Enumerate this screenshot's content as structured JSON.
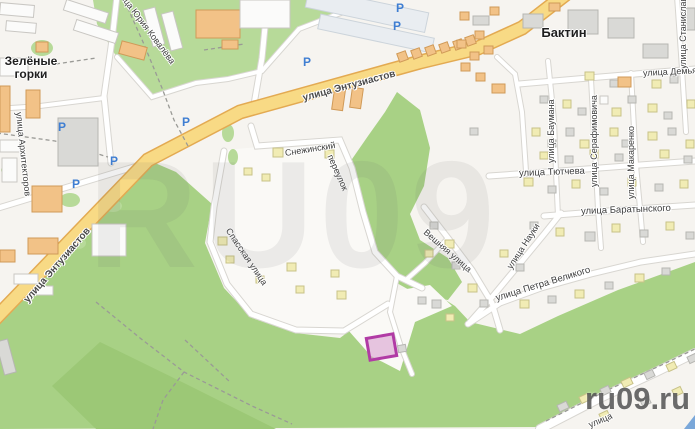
{
  "watermarks": {
    "big": "RU09",
    "corner": "ru09.ru"
  },
  "colors": {
    "base": "#f6f4f0",
    "pocket": "#faf9f6",
    "green_light": "#b7da99",
    "green_mid": "#a8d185",
    "green_dark": "#9cc876",
    "road_yellow": "#f8da85",
    "road_yellow_casing": "#e3aa52",
    "road_white": "#ffffff",
    "road_casing": "#d8d6d1",
    "dashed_path": "#9a9a96",
    "parking_blue": "#3f7ed2",
    "selection_border": "#b13ba5",
    "selection_fill": "rgba(216,160,208,0.6)",
    "corner_triangle": "#7aa7d9"
  },
  "place_labels": [
    {
      "text": "Зелёные горки",
      "x": 2,
      "y": 55,
      "size": 12,
      "width": 58
    },
    {
      "text": "Бактин",
      "x": 534,
      "y": 26,
      "size": 13,
      "width": 60
    }
  ],
  "street_labels": [
    {
      "text": "улица Энтузиастов",
      "x": 303,
      "y": 93,
      "rot": -15,
      "size": 10,
      "bold": true
    },
    {
      "text": "улица Энтузиастов",
      "x": 26,
      "y": 296,
      "rot": -49,
      "size": 10,
      "bold": true
    },
    {
      "text": "улица Юрия Ковалёва",
      "x": 117,
      "y": -17,
      "rot": 53,
      "size": 9
    },
    {
      "text": "улица Архитекторов",
      "x": 19,
      "y": 107,
      "rot": 84,
      "size": 9
    },
    {
      "text": "Снежинский",
      "x": 285,
      "y": 148,
      "rot": -9,
      "size": 9
    },
    {
      "text": "переулок",
      "x": 330,
      "y": 150,
      "rot": 66,
      "size": 9
    },
    {
      "text": "Спасская улица",
      "x": 228,
      "y": 224,
      "rot": 56,
      "size": 9
    },
    {
      "text": "Вешняя улица",
      "x": 425,
      "y": 226,
      "rot": 41,
      "size": 9
    },
    {
      "text": "улица Науки",
      "x": 509,
      "y": 263,
      "rot": -57,
      "size": 9
    },
    {
      "text": "улица Петра Великого",
      "x": 496,
      "y": 293,
      "rot": -17,
      "size": 9.5
    },
    {
      "text": "улица Тютчева",
      "x": 519,
      "y": 168,
      "rot": -2,
      "size": 9.5
    },
    {
      "text": "улица Баратынского",
      "x": 581,
      "y": 206,
      "rot": -2,
      "size": 9.5
    },
    {
      "text": "улица Баумана",
      "x": 551,
      "y": 158,
      "rot": -90,
      "size": 9
    },
    {
      "text": "улица Серафимовича",
      "x": 594,
      "y": 182,
      "rot": -90,
      "size": 9
    },
    {
      "text": "улица Макаренко",
      "x": 631,
      "y": 194,
      "rot": -90,
      "size": 9
    },
    {
      "text": "улица Станислав",
      "x": 683,
      "y": 64,
      "rot": -90,
      "size": 9
    },
    {
      "text": "улица Демьяна",
      "x": 643,
      "y": 68,
      "rot": -3,
      "size": 9
    },
    {
      "text": "улица",
      "x": 589,
      "y": 420,
      "rot": -23,
      "size": 9
    }
  ],
  "parking_icons": {
    "glyph": "P",
    "positions": [
      [
        58,
        121
      ],
      [
        72,
        178
      ],
      [
        110,
        155
      ],
      [
        182,
        116
      ],
      [
        303,
        56
      ],
      [
        393,
        20
      ],
      [
        396,
        2
      ]
    ]
  },
  "selection": {
    "x": 368,
    "y": 336,
    "w": 27,
    "h": 22,
    "rot": -10
  },
  "geometry": {
    "green_light_polys": [
      "93,0 345,0 336,16 298,30 260,72 228,80 194,82 152,98 116,56 97,24"
    ],
    "green_mid_polys": [
      "0,318 148,160 176,172 212,204 205,243 224,288 252,318 295,333 340,338 380,308 430,290 455,306 470,322 520,334 558,316 618,290 695,262 695,352 656,371 598,399 545,427 0,429",
      "397,92 420,110 430,148 424,186 410,214 420,240 448,258 462,282 448,300 420,296 395,282 372,252 362,222 346,196 350,162 368,136 385,112"
    ],
    "green_dark_polys": [
      "100,342 186,384 258,420 276,429 96,429 52,386"
    ],
    "pocket_polys": [
      "224,150 342,140 352,168 374,252 397,278 391,302 343,332 295,328 249,312 226,283 209,243 215,206",
      "336,301 430,285 452,306 415,322 400,371 371,356 348,330"
    ],
    "green_ovals": [
      [
        42,
        48,
        11,
        8
      ],
      [
        70,
        200,
        10,
        7
      ],
      [
        113,
        206,
        9,
        6
      ],
      [
        78,
        243,
        8,
        6
      ],
      [
        228,
        133,
        6,
        9
      ],
      [
        233,
        157,
        5,
        8
      ],
      [
        8,
        170,
        7,
        5
      ]
    ],
    "roads_yellow": [
      "M -8,322 L 148,160 L 240,112 L 420,62 L 478,48 L 522,28 L 566,-6"
    ],
    "roads_white": [
      [
        "M 268,-4 L 262,58 L 253,110",
        5
      ],
      [
        "M 251,126 L 257,146 L 340,140 L 352,168 L 363,212 L 375,252 L 397,276 L 422,288",
        5
      ],
      [
        "M 224,151 L 214,207 L 210,242 L 227,284 L 251,314 L 296,330 L 344,331 L 388,304",
        5
      ],
      [
        "M 397,276 L 390,312 L 401,347 L 412,374",
        4
      ],
      [
        "M 424,207 L 448,238 L 472,270 L 492,303 L 500,330",
        5
      ],
      [
        "M 448,238 L 425,263 L 407,279",
        4
      ],
      [
        "M 470,322 L 493,296 L 517,267 L 545,233 L 561,213",
        5
      ],
      [
        "M 468,324 L 500,303 L 541,288 L 591,274 L 641,262 L 695,254",
        5
      ],
      [
        "M 489,176 L 560,171 L 640,165 L 695,161",
        5
      ],
      [
        "M 544,216 L 620,210 L 695,205",
        5
      ],
      [
        "M 519,84 L 600,77 L 695,69",
        5
      ],
      [
        "M 548,61 L 554,120 L 556,172 L 558,216",
        4
      ],
      [
        "M 591,79 L 596,170 L 598,209 L 601,248",
        4
      ],
      [
        "M 631,73 L 636,165 L 640,208 L 643,242",
        4
      ],
      [
        "M 677,-4 L 682,69 L 686,132",
        4
      ],
      [
        "M 497,57 L 515,74 L 522,112 L 526,171",
        4
      ],
      [
        "M 540,429 L 600,398 L 656,372 L 695,353",
        8
      ],
      [
        "M -5,209 L 147,163",
        5
      ],
      [
        "M 111,163 L 104,96 L 112,40 L 117,-4",
        5
      ],
      [
        "M 104,98 L 40,106 L -4,109",
        4
      ],
      [
        "M 117,57 L 152,97 L 196,83 L 228,79 L 262,71 L 299,29 L 338,14 L 362,6",
        4
      ]
    ],
    "dashed_paths": [
      "M 122,-5 L 143,42 L 162,88 L 174,120 L 188,146",
      "M -3,133 L 55,141 L 108,157",
      "M 96,302 L 140,338 L 184,372 L 216,388 L 252,406 L 292,424",
      "M 184,372 L 163,400 L 153,429",
      "M 185,340 L 230,382",
      "M 546,421 L 610,389 L 670,361 L 695,349",
      "M 56,64 L 96,58",
      "M 204,50 L 244,44"
    ],
    "buildings": [
      [
        64,
        6,
        44,
        11,
        "w",
        18
      ],
      [
        74,
        26,
        44,
        11,
        "w",
        18
      ],
      [
        148,
        8,
        12,
        38,
        "w",
        -15
      ],
      [
        166,
        12,
        12,
        38,
        "w",
        -15
      ],
      [
        196,
        10,
        44,
        28,
        "o",
        0
      ],
      [
        222,
        40,
        16,
        9,
        "o",
        0
      ],
      [
        240,
        0,
        50,
        28,
        "w",
        0
      ],
      [
        306,
        0,
        122,
        20,
        "lg",
        12
      ],
      [
        318,
        26,
        116,
        15,
        "lg",
        12
      ],
      [
        398,
        52,
        9,
        9,
        "o",
        -20
      ],
      [
        412,
        49,
        9,
        9,
        "o",
        -20
      ],
      [
        426,
        46,
        9,
        9,
        "o",
        -20
      ],
      [
        440,
        43,
        9,
        9,
        "o",
        -20
      ],
      [
        454,
        40,
        9,
        9,
        "o",
        -20
      ],
      [
        466,
        36,
        9,
        9,
        "o",
        -20
      ],
      [
        333,
        90,
        11,
        20,
        "o",
        8
      ],
      [
        351,
        88,
        11,
        20,
        "o",
        8
      ],
      [
        120,
        44,
        26,
        13,
        "o",
        15
      ],
      [
        36,
        42,
        12,
        10,
        "o",
        0
      ],
      [
        0,
        4,
        34,
        12,
        "w",
        5
      ],
      [
        6,
        22,
        30,
        10,
        "w",
        5
      ],
      [
        0,
        58,
        28,
        18,
        "w",
        0
      ],
      [
        0,
        86,
        10,
        46,
        "o",
        0
      ],
      [
        26,
        90,
        14,
        28,
        "o",
        0
      ],
      [
        58,
        118,
        40,
        48,
        "g",
        0
      ],
      [
        0,
        140,
        20,
        12,
        "w",
        0
      ],
      [
        2,
        158,
        15,
        24,
        "w",
        0
      ],
      [
        32,
        186,
        30,
        26,
        "o",
        0
      ],
      [
        28,
        238,
        30,
        16,
        "o",
        0
      ],
      [
        92,
        224,
        34,
        32,
        "w",
        0
      ],
      [
        0,
        250,
        15,
        12,
        "o",
        0
      ],
      [
        14,
        274,
        24,
        10,
        "w",
        0
      ],
      [
        36,
        286,
        17,
        9,
        "w",
        0
      ],
      [
        0,
        340,
        12,
        34,
        "g",
        -15
      ],
      [
        460,
        12,
        9,
        8,
        "o",
        0
      ],
      [
        473,
        16,
        16,
        9,
        "g",
        0
      ],
      [
        475,
        31,
        9,
        8,
        "o",
        0
      ],
      [
        490,
        7,
        9,
        8,
        "o",
        0
      ],
      [
        523,
        14,
        20,
        14,
        "g",
        0
      ],
      [
        549,
        3,
        11,
        8,
        "o",
        0
      ],
      [
        568,
        10,
        30,
        24,
        "g",
        0
      ],
      [
        608,
        18,
        26,
        20,
        "g",
        0
      ],
      [
        643,
        44,
        25,
        14,
        "g",
        0
      ],
      [
        683,
        8,
        12,
        22,
        "g",
        0
      ],
      [
        457,
        40,
        9,
        8,
        "o",
        0
      ],
      [
        470,
        52,
        9,
        8,
        "o",
        0
      ],
      [
        484,
        46,
        9,
        8,
        "o",
        0
      ],
      [
        461,
        63,
        9,
        8,
        "o",
        0
      ],
      [
        476,
        73,
        9,
        8,
        "o",
        0
      ],
      [
        492,
        84,
        13,
        9,
        "o",
        0
      ],
      [
        585,
        72,
        9,
        8,
        "py",
        0
      ],
      [
        610,
        80,
        8,
        7,
        "g",
        0
      ],
      [
        618,
        77,
        13,
        10,
        "o",
        0
      ],
      [
        652,
        80,
        9,
        8,
        "py",
        0
      ],
      [
        670,
        76,
        8,
        7,
        "g",
        0
      ],
      [
        540,
        96,
        8,
        7,
        "g",
        0
      ],
      [
        563,
        100,
        8,
        8,
        "py",
        0
      ],
      [
        578,
        108,
        8,
        7,
        "g",
        0
      ],
      [
        600,
        96,
        8,
        8,
        "w",
        0
      ],
      [
        612,
        108,
        9,
        8,
        "py",
        0
      ],
      [
        628,
        96,
        8,
        7,
        "g",
        0
      ],
      [
        648,
        104,
        9,
        8,
        "py",
        0
      ],
      [
        664,
        112,
        8,
        7,
        "g",
        0
      ],
      [
        687,
        100,
        8,
        8,
        "py",
        0
      ],
      [
        470,
        128,
        8,
        7,
        "g",
        0
      ],
      [
        532,
        128,
        8,
        8,
        "py",
        0
      ],
      [
        548,
        140,
        8,
        7,
        "g",
        0
      ],
      [
        566,
        128,
        8,
        8,
        "g",
        0
      ],
      [
        580,
        140,
        9,
        8,
        "py",
        0
      ],
      [
        610,
        128,
        8,
        8,
        "py",
        0
      ],
      [
        622,
        140,
        8,
        7,
        "g",
        0
      ],
      [
        648,
        132,
        9,
        8,
        "py",
        0
      ],
      [
        668,
        128,
        8,
        7,
        "g",
        0
      ],
      [
        686,
        140,
        8,
        8,
        "py",
        0
      ],
      [
        540,
        152,
        8,
        7,
        "py",
        0
      ],
      [
        565,
        156,
        8,
        7,
        "g",
        0
      ],
      [
        590,
        150,
        8,
        8,
        "py",
        0
      ],
      [
        615,
        154,
        8,
        7,
        "g",
        0
      ],
      [
        660,
        150,
        9,
        8,
        "py",
        0
      ],
      [
        684,
        156,
        8,
        7,
        "g",
        0
      ],
      [
        524,
        178,
        9,
        8,
        "py",
        0
      ],
      [
        548,
        186,
        8,
        7,
        "g",
        0
      ],
      [
        572,
        180,
        8,
        8,
        "py",
        0
      ],
      [
        600,
        188,
        8,
        7,
        "g",
        0
      ],
      [
        628,
        178,
        8,
        8,
        "py",
        0
      ],
      [
        655,
        184,
        8,
        7,
        "g",
        0
      ],
      [
        680,
        180,
        8,
        8,
        "py",
        0
      ],
      [
        530,
        222,
        8,
        7,
        "g",
        0
      ],
      [
        556,
        228,
        8,
        8,
        "py",
        0
      ],
      [
        585,
        232,
        10,
        9,
        "g",
        0
      ],
      [
        612,
        224,
        8,
        8,
        "py",
        0
      ],
      [
        640,
        230,
        8,
        7,
        "g",
        0
      ],
      [
        666,
        222,
        8,
        8,
        "py",
        0
      ],
      [
        686,
        232,
        8,
        7,
        "g",
        0
      ],
      [
        430,
        222,
        8,
        7,
        "g",
        0
      ],
      [
        445,
        240,
        9,
        8,
        "py",
        0
      ],
      [
        425,
        250,
        8,
        7,
        "py",
        0
      ],
      [
        452,
        262,
        8,
        7,
        "g",
        0
      ],
      [
        468,
        284,
        9,
        8,
        "py",
        0
      ],
      [
        480,
        300,
        8,
        7,
        "g",
        0
      ],
      [
        432,
        300,
        9,
        8,
        "g",
        0
      ],
      [
        446,
        314,
        8,
        7,
        "py",
        0
      ],
      [
        500,
        250,
        8,
        7,
        "py",
        0
      ],
      [
        516,
        264,
        8,
        7,
        "g",
        0
      ],
      [
        520,
        300,
        9,
        8,
        "py",
        0
      ],
      [
        548,
        296,
        8,
        7,
        "g",
        0
      ],
      [
        575,
        290,
        9,
        8,
        "py",
        0
      ],
      [
        605,
        282,
        8,
        7,
        "g",
        0
      ],
      [
        635,
        274,
        9,
        8,
        "py",
        0
      ],
      [
        662,
        268,
        8,
        7,
        "g",
        0
      ],
      [
        273,
        148,
        10,
        9,
        "py",
        0
      ],
      [
        325,
        150,
        9,
        8,
        "py",
        0
      ],
      [
        244,
        168,
        8,
        7,
        "py",
        0
      ],
      [
        262,
        174,
        8,
        7,
        "py",
        0
      ],
      [
        218,
        237,
        9,
        8,
        "py",
        0
      ],
      [
        226,
        256,
        8,
        7,
        "py",
        0
      ],
      [
        256,
        276,
        8,
        7,
        "py",
        0
      ],
      [
        287,
        263,
        9,
        8,
        "py",
        0
      ],
      [
        296,
        286,
        8,
        7,
        "py",
        0
      ],
      [
        331,
        270,
        8,
        7,
        "py",
        0
      ],
      [
        337,
        291,
        9,
        8,
        "py",
        0
      ],
      [
        418,
        297,
        8,
        7,
        "g",
        0
      ],
      [
        398,
        345,
        8,
        7,
        "g",
        -10
      ],
      [
        558,
        403,
        10,
        7,
        "g",
        -25
      ],
      [
        580,
        395,
        9,
        7,
        "py",
        -25
      ],
      [
        601,
        387,
        9,
        7,
        "g",
        -25
      ],
      [
        622,
        379,
        10,
        7,
        "py",
        -25
      ],
      [
        645,
        371,
        9,
        7,
        "g",
        -25
      ],
      [
        667,
        363,
        9,
        7,
        "py",
        -25
      ],
      [
        688,
        355,
        9,
        7,
        "g",
        -25
      ],
      [
        600,
        412,
        9,
        7,
        "py",
        -25
      ],
      [
        641,
        398,
        9,
        7,
        "g",
        -25
      ],
      [
        673,
        388,
        9,
        7,
        "py",
        -25
      ]
    ],
    "corner_triangle": "684,429 695,415 695,429"
  }
}
